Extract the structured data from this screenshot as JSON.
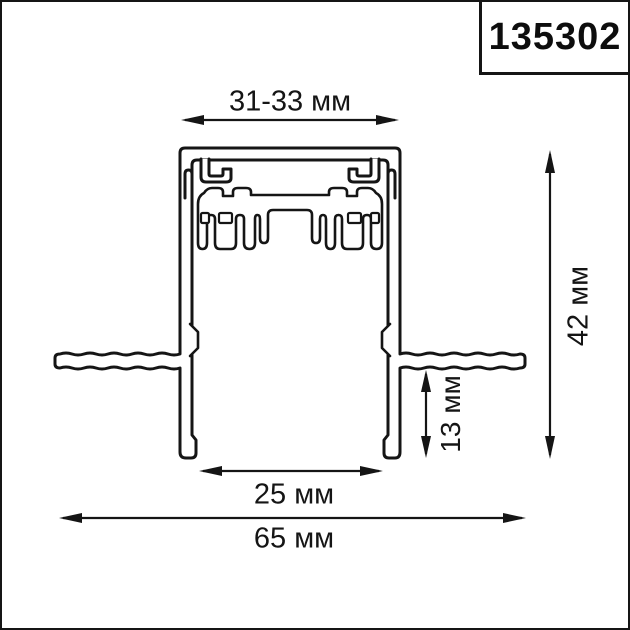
{
  "article_box": {
    "number": "135302"
  },
  "dimensions": {
    "top_width": "31-33 мм",
    "overall_height": "42 мм",
    "flange_to_bottom": "13 мм",
    "bottom_opening": "25 мм",
    "overall_width": "65 мм"
  },
  "colors": {
    "line": "#151515",
    "background": "#ffffff",
    "text": "#151515"
  }
}
